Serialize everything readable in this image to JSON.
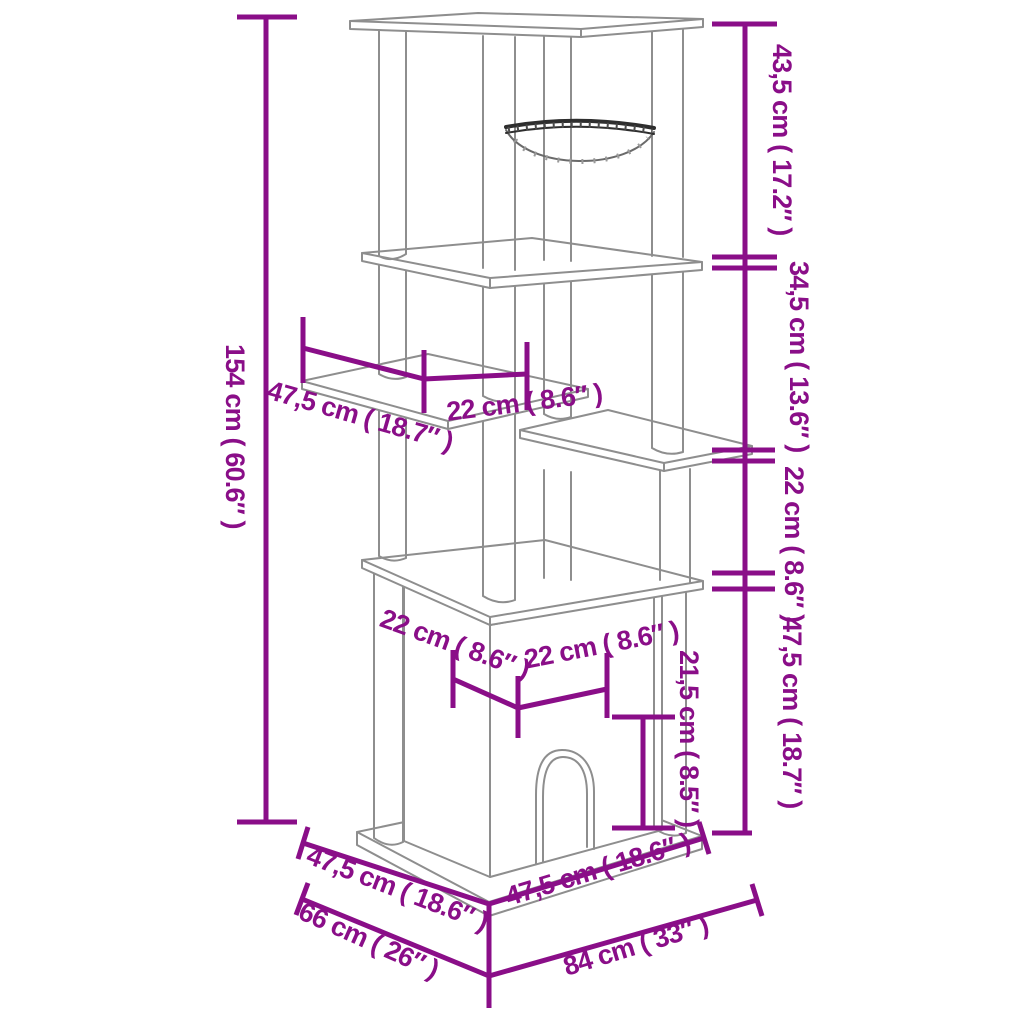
{
  "diagram": {
    "type": "product-dimension-drawing",
    "subject": "cat-scratching-post-tower-with-hammock-platforms-and-house",
    "colors": {
      "dimension_accent": "#8A0E88",
      "structure_line": "#8E8E8E",
      "hammock_rim": "#2E2E2E",
      "background": "#FFFFFF"
    },
    "dimensions": {
      "overall_height": "154 cm ( 60.6″ )",
      "top_tier_height": "43,5 cm ( 17.2″ )",
      "upper_mid_tier_height": "34,5 cm ( 13.6″ )",
      "lower_mid_tier_height": "22 cm ( 8.6″ )",
      "bottom_tier_height": "47,5 cm ( 18.7″ )",
      "side_platform_depth": "47,5 cm ( 18.7″ )",
      "side_platform_width": "22 cm ( 8.6″ )",
      "house_roof_depth": "22 cm ( 8.6″ )",
      "house_roof_width": "22 cm ( 8.6″ )",
      "door_height": "21,5 cm ( 8.5″ )",
      "base_board_depth": "47,5 cm ( 18.6″ )",
      "footprint_depth": "66 cm ( 26″ )",
      "base_board_width": "47,5 cm ( 18.6″ )",
      "footprint_width": "84 cm ( 33″ )"
    }
  }
}
